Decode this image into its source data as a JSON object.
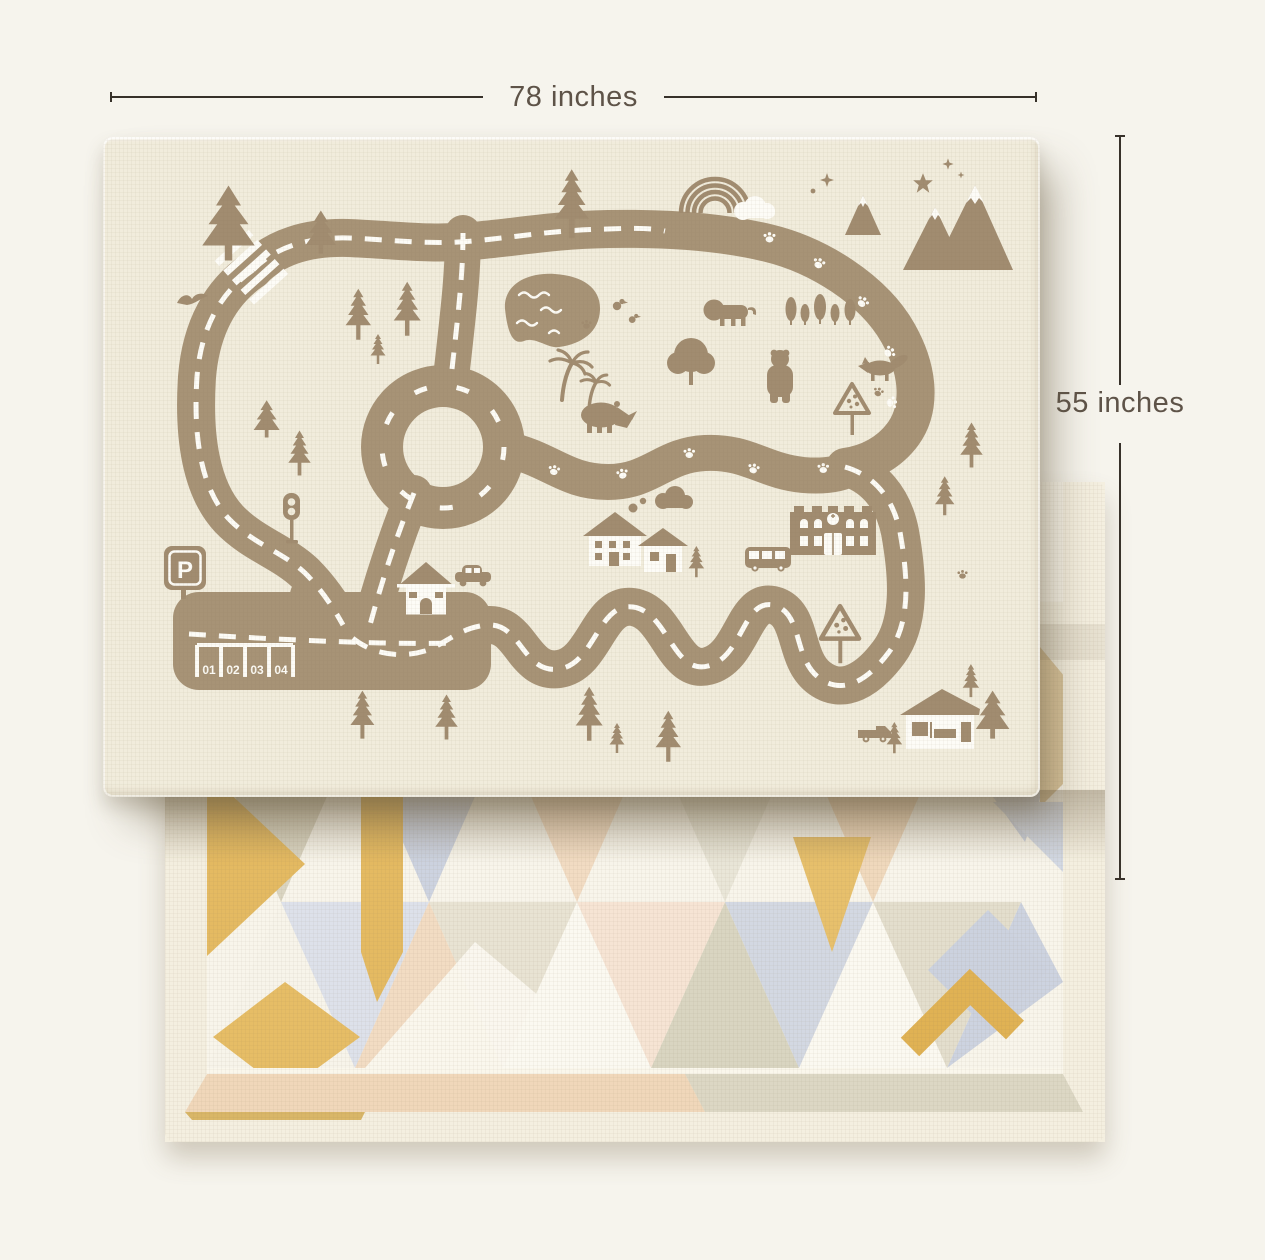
{
  "canvas": {
    "width": 1265,
    "height": 1260,
    "background": "#f6f4ed"
  },
  "annotations": {
    "width_label": "78 inches",
    "height_label": "55 inches",
    "line_color": "#37312a",
    "text_color": "#5e5348"
  },
  "mat_road": {
    "name": "reversible baby play mat - road side (top)",
    "base_color": "#f1ecdc",
    "print_color": "#a79376",
    "accent_white": "#fdfcf7",
    "parking": {
      "sign_label": "P",
      "spot_labels": [
        "01",
        "02",
        "03",
        "04"
      ]
    },
    "elements": [
      "road-loop",
      "roundabout",
      "crosswalk",
      "parking-lot",
      "traffic-light",
      "pond",
      "rainbow",
      "cloud",
      "mountains",
      "stars",
      "bird",
      "pine-trees",
      "fir-trees",
      "palm-trees",
      "round-tree",
      "lion",
      "bear",
      "fox",
      "rhino",
      "ducks",
      "houses",
      "school",
      "bus",
      "car",
      "truck",
      "warning-signs",
      "paw-prints"
    ]
  },
  "mat_geometric": {
    "name": "reversible baby play mat - geometric side (bottom)",
    "base_color": "#f8f5eb",
    "border_color": "#f4efe0",
    "palette": [
      "#e4ba62",
      "#f2dcc3",
      "#ccd2df",
      "#d9d5c1",
      "#fbf9f1",
      "#f6e4d4",
      "#dde1ea",
      "#d9c49c"
    ]
  }
}
